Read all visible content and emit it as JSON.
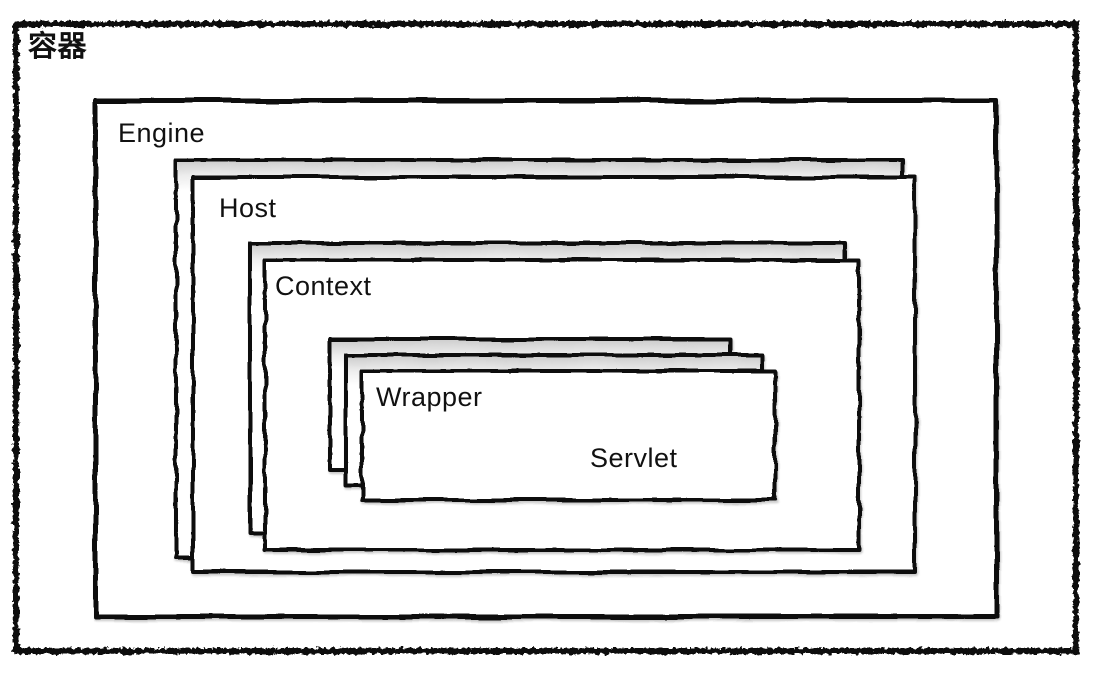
{
  "diagram": {
    "background_color": "#ffffff",
    "line_color": "#0d0d0d",
    "text_color": "#111111",
    "style": "hand-drawn nested containment diagram",
    "boxes": [
      {
        "id": "container",
        "label": "容器",
        "layers": 1
      },
      {
        "id": "engine",
        "label": "Engine",
        "layers": 1
      },
      {
        "id": "host",
        "label": "Host",
        "layers": 2
      },
      {
        "id": "context",
        "label": "Context",
        "layers": 2
      },
      {
        "id": "wrapper",
        "label": "Wrapper",
        "layers": 3
      },
      {
        "id": "servlet",
        "label": "Servlet",
        "layers": 1
      }
    ],
    "nesting_order": [
      "容器",
      "Engine",
      "Host",
      "Context",
      "Wrapper",
      "Servlet"
    ]
  }
}
